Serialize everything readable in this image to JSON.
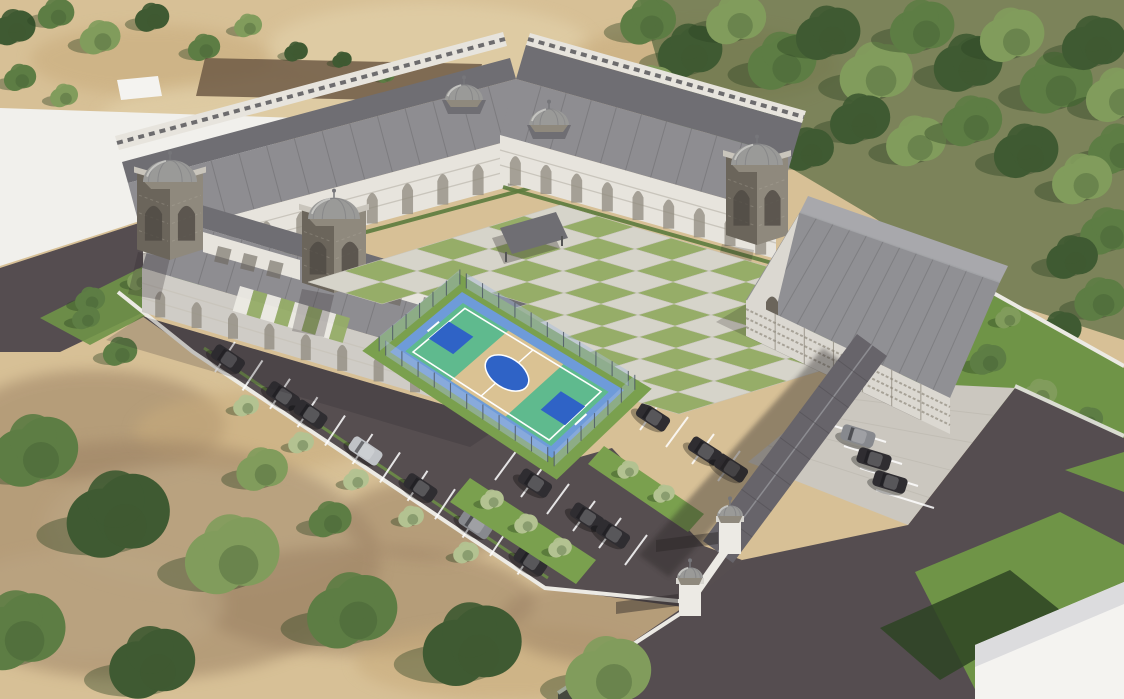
{
  "scene": {
    "type": "aerial-architectural-3d-render",
    "subject": "Aerial 3D rendering of a school campus with Ottoman-style domed buildings, checkerboard courtyard, fenced basketball court, gymnasium, parking lots with cars, entrance gate, boundary wall, trees and sandy terrain",
    "elements": [
      "u-shaped three-story school building with arched arcade facades",
      "gray domes on corner towers and roof ridge",
      "checkerboard paved courtyard",
      "fenced blue-green basketball court",
      "gymnasium hall with gabled roof",
      "covered walkway canopy",
      "entrance gate with twin domed pillars",
      "asphalt parking lots with white stripes and parked cars",
      "white boundary wall with planted trees",
      "dense tree rows",
      "sandy dry terrain",
      "access roads",
      "white flat lot",
      "white flat-roof building at bottom right"
    ]
  },
  "colors": {
    "sand": "#d7c096",
    "sand2": "#c8ab7b",
    "sand3": "#e4d4ae",
    "dirt": "#9b8163",
    "dirtrect": "#6f5a45",
    "white_lot": "#f1f0ec",
    "road": "#554d50",
    "asphalt": "#564e50",
    "wall": "#eceae4",
    "paver": "#cbc7bf",
    "grass": "#7aa04e",
    "lawn": "#6f9447",
    "grass_dark": "#2e4423",
    "checker_a": "#d6d4ca",
    "checker_b": "#96ad68",
    "roof": "#8e8d91",
    "roof_dark": "#6f6e73",
    "roof_light": "#a6a7ab",
    "facade": "#e7e4dd",
    "facade_sh": "#c9c5bc",
    "stone": "#8f897d",
    "stone_dark": "#6b655b",
    "dome": "#9a9a98",
    "dome_dark": "#76767a",
    "dome_light": "#cfcfcc",
    "court_border": "#6e9bd9",
    "court_green": "#5fba8e",
    "court_tan": "#dac293",
    "court_key": "#2f63c6",
    "fence": "#a9bddd",
    "tree1": "#3f5a32",
    "tree2": "#5d7d44",
    "tree3": "#819c5c",
    "tree_pale": "#b3c291",
    "car_dark": "#2f2d31",
    "car_gray": "#87898e",
    "car_silver": "#c0c3c7",
    "canopy": "#67646a",
    "gym_roof": "#a8a8ac",
    "gym_roof2": "#909094",
    "gym_wall": "#dbd8d1",
    "lattice": "#857f72",
    "white_bldg": "#f4f3f0",
    "line": "#ffffff",
    "shadow": "#2a2526"
  }
}
